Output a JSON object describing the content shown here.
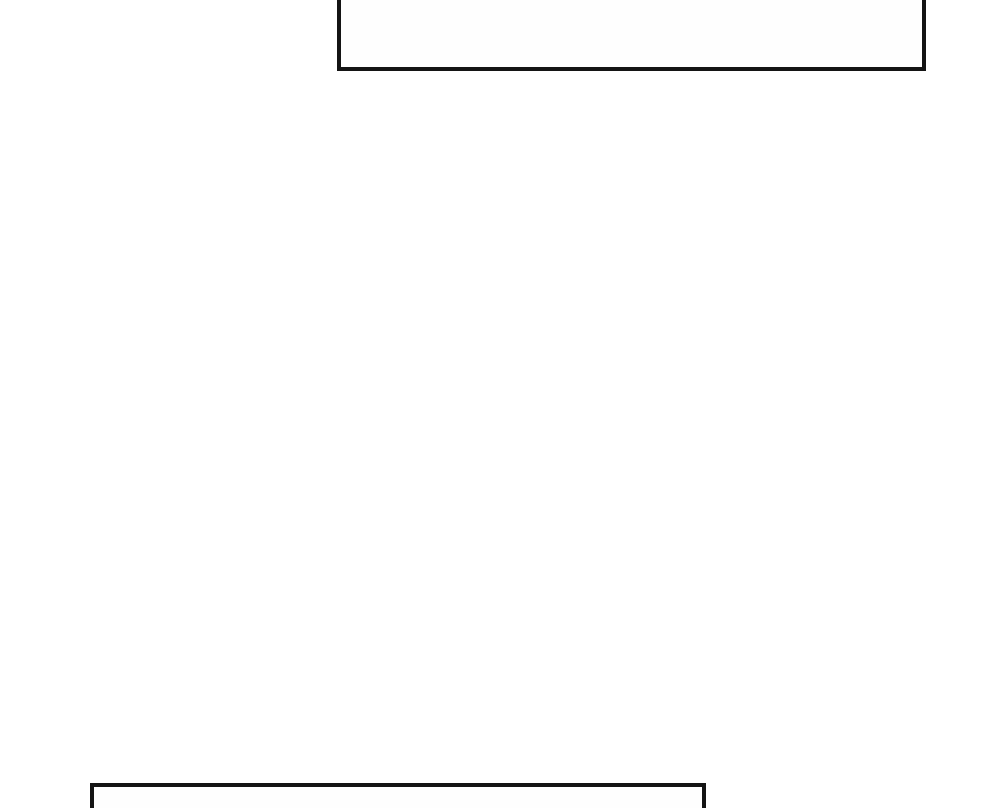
{
  "theme": {
    "page-bg": "#ffffff",
    "panel-bg": "#fefefe",
    "panel-border-color": "#141414"
  },
  "panels": [
    {
      "id": "top-panel",
      "content": ""
    },
    {
      "id": "bottom-panel",
      "content": ""
    }
  ]
}
